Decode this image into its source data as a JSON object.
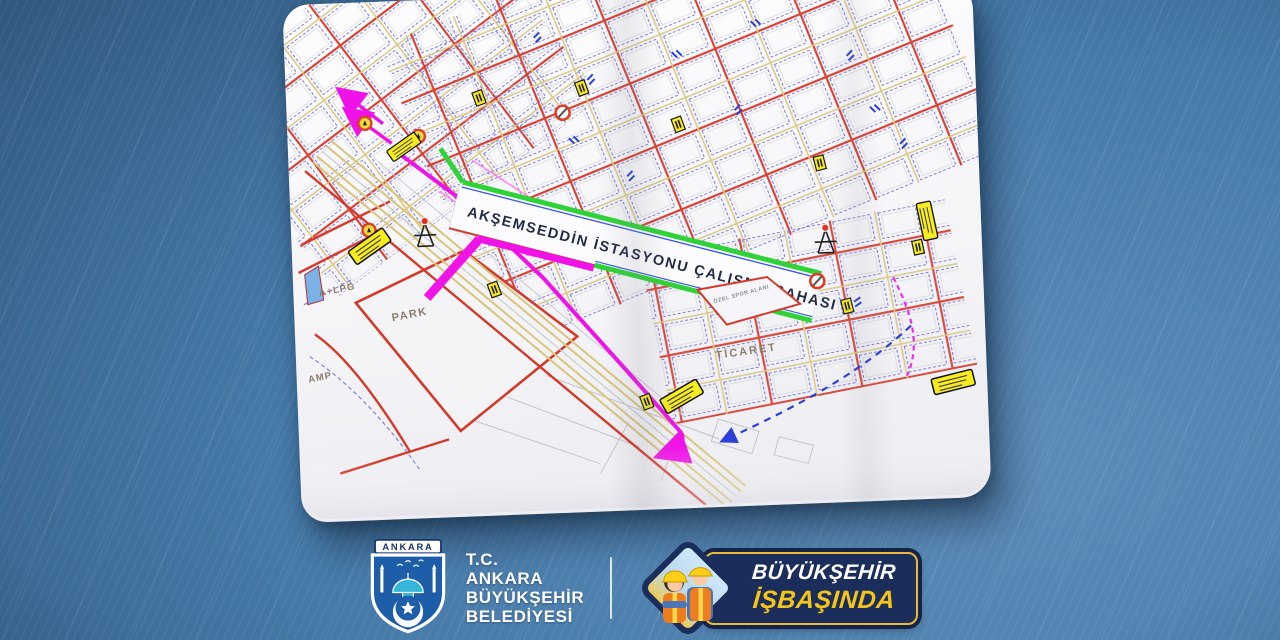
{
  "map": {
    "title": "AKŞEMSEDDİN İSTASYONU ÇALIŞMA SAHASI",
    "labels": {
      "park": "PARK",
      "lpg": "A+LPG",
      "amp": "AMP",
      "ticaret": "TİCARET",
      "ozel_spor_alani": "ÖZEL SPOR ALANI"
    }
  },
  "footer": {
    "logo_banner": "ANKARA",
    "org": {
      "line1": "T.C.",
      "line2": "ANKARA",
      "line3": "BÜYÜKŞEHİR",
      "line4": "BELEDİYESİ"
    },
    "campaign": {
      "line1": "BÜYÜKŞEHİR",
      "line2": "İŞBAŞINDA"
    }
  },
  "colors": {
    "background_dark": "#2a5376",
    "background_light": "#5b8ab7",
    "paper": "#f6f6f8",
    "road_red": "#d43a2b",
    "parcel_blue": "#8080d6",
    "road_tan": "#d8c57e",
    "work_zone_green": "#2fd337",
    "route_magenta": "#f013e8",
    "sign_yellow": "#f6e923",
    "badge_navy": "#1b2d5b",
    "badge_gold": "#e7b93c",
    "campaign_yellow": "#f5c518"
  }
}
